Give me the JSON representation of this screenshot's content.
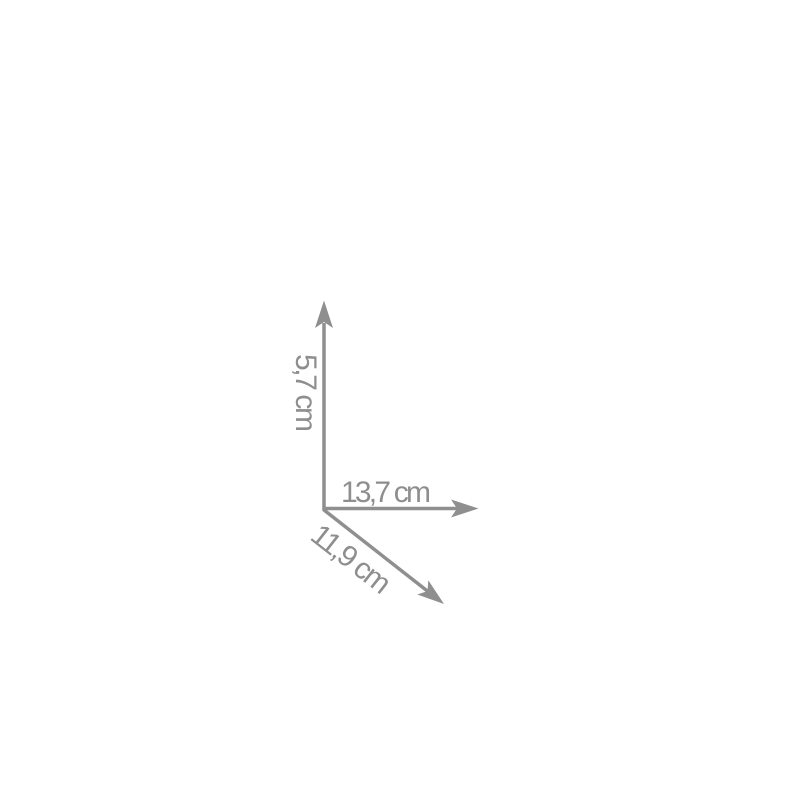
{
  "diagram": {
    "background": "#ffffff",
    "colors": {
      "arrow": "#8f8f8f",
      "text": "#8e8e8e"
    },
    "dimensions": {
      "height": {
        "label": "5,7 cm",
        "value": "5,7",
        "unit": "cm"
      },
      "width": {
        "label": "13,7 cm",
        "value": "13,7",
        "unit": "cm"
      },
      "depth": {
        "label": "11,9 cm",
        "value": "11,9",
        "unit": "cm"
      }
    }
  }
}
